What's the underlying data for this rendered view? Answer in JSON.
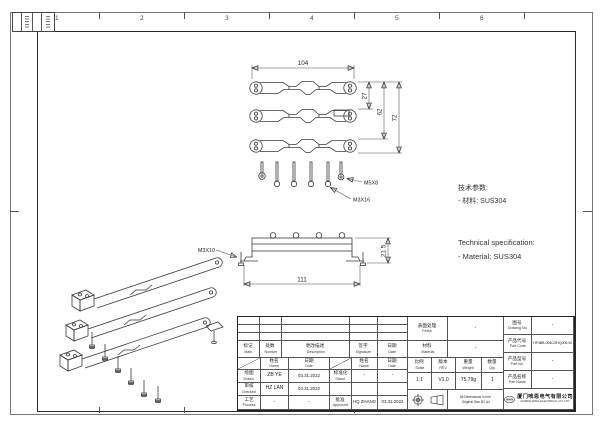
{
  "border": {
    "zones": [
      "1",
      "2",
      "3",
      "4",
      "5",
      "6"
    ]
  },
  "views": {
    "top": {
      "dim_width": "104",
      "dim_gap": "27",
      "dim_mid": "62",
      "dim_total": "72"
    },
    "screws": {
      "label_short": "M5X8",
      "label_long": "M3X16"
    },
    "front": {
      "dim_width": "111",
      "dim_height": "21.5",
      "label_screw": "M3X10"
    }
  },
  "notes": {
    "zh_title": "技术参数:",
    "zh_material": "- 材料: SUS304",
    "en_title": "Technical specification:",
    "en_material": "- Material: SUS304"
  },
  "titleblock": {
    "rev_header": {
      "mark_zh": "标记",
      "mark_en": "Mark",
      "number_zh": "处数",
      "number_en": "Number",
      "desc_zh": "更改描述",
      "desc_en": "Description",
      "sig_zh": "签字",
      "sig_en": "Signature",
      "date_zh": "日期",
      "date_en": "Date"
    },
    "sub": {
      "name_zh": "姓名",
      "name_en": "Name",
      "date_zh": "日期",
      "date_en": "Date"
    },
    "rows": {
      "drawn": {
        "zh": "绘图",
        "en": "Drawn",
        "name": "ZB YE",
        "date": "03.31.2022"
      },
      "checked": {
        "zh": "审核",
        "en": "Checked",
        "name": "HZ LAN",
        "date": "03.31.2022"
      },
      "process": {
        "zh": "工艺",
        "en": "Process",
        "name": "-",
        "date": "-"
      },
      "stand": {
        "zh": "标准化",
        "en": "Stand",
        "name": "-",
        "date": "-"
      },
      "approved": {
        "zh": "批准",
        "en": "Approved",
        "name": "HQ ZHANG",
        "date": "03.31.2022"
      }
    },
    "finish": {
      "zh": "表面处理",
      "en": "Finish",
      "value": "-"
    },
    "material": {
      "zh": "材料",
      "en": "Material",
      "value": "-"
    },
    "scale": {
      "zh": "比例",
      "en": "Scale",
      "value": "1:1"
    },
    "rev": {
      "zh": "版本",
      "en": "REV.",
      "value": "V1.0"
    },
    "weight": {
      "zh": "重量",
      "en": "Weight",
      "value": "75.79g"
    },
    "qty": {
      "zh": "数量",
      "en": "Qty.",
      "value": "1"
    },
    "note1": "All Dimensions in mm",
    "note2": "Original Size BY A4",
    "drawing_no": {
      "zh": "图号",
      "en": "Drawing No.",
      "value": "-"
    },
    "part_code": {
      "zh": "产品代号",
      "en": "Part Code",
      "value": "HF4BB-004C/2HQ005-W"
    },
    "part_no": {
      "zh": "产品型号",
      "en": "Part No.",
      "value": "-"
    },
    "part_name": {
      "zh": "产品名称",
      "en": "Part Name",
      "value": "-"
    },
    "company": {
      "logo": "WAIN",
      "zh": "厦门唯恩电气有限公司",
      "en": "XIAMEN WAIN ELECTRICAL CO.,LTD"
    }
  }
}
